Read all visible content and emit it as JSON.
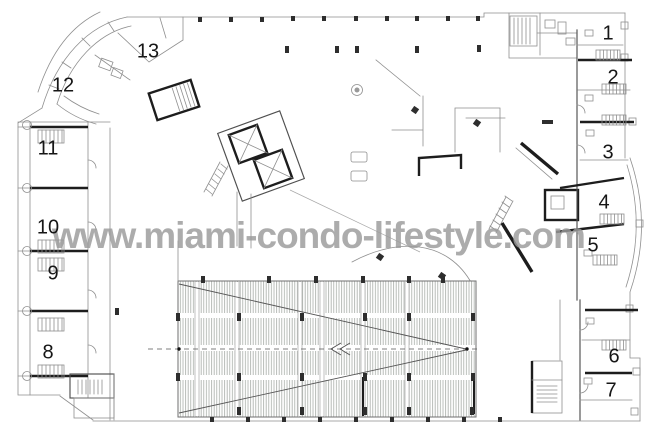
{
  "page": {
    "background": "#ffffff"
  },
  "watermark": {
    "text": "www.miami-condo-lifestyle.com",
    "color": "#9b9b9b"
  },
  "plan": {
    "type": "architectural-floor-plan",
    "colors": {
      "wall": "#1d1d1d",
      "line": "#8f8f8f",
      "medium": "#4f4f4f",
      "hatch": "#a9aea9",
      "marker": "#2e2e2e"
    },
    "units": [
      {
        "label": "1",
        "x": 608,
        "y": 34
      },
      {
        "label": "2",
        "x": 613,
        "y": 78
      },
      {
        "label": "3",
        "x": 608,
        "y": 153
      },
      {
        "label": "4",
        "x": 604,
        "y": 203
      },
      {
        "label": "5",
        "x": 593,
        "y": 246
      },
      {
        "label": "6",
        "x": 614,
        "y": 357
      },
      {
        "label": "7",
        "x": 611,
        "y": 391
      },
      {
        "label": "8",
        "x": 48,
        "y": 353
      },
      {
        "label": "9",
        "x": 53,
        "y": 274
      },
      {
        "label": "10",
        "x": 48,
        "y": 228
      },
      {
        "label": "11",
        "x": 48,
        "y": 149
      },
      {
        "label": "12",
        "x": 63,
        "y": 86
      },
      {
        "label": "13",
        "x": 148,
        "y": 52
      }
    ]
  }
}
